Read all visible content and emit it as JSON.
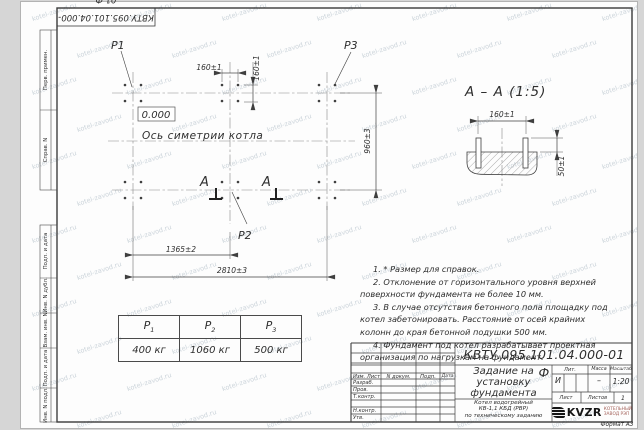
{
  "watermark": "kotel-zavod.ru",
  "corner_stamp": "КВТУ.095.101.04.000-01 Ф",
  "margin_labels": [
    "Перв. примен.",
    "Справ. N",
    "Подп. и дата",
    "Инв. N дубл.",
    "Взам. инв. N",
    "Подп. и дата",
    "Инв. N подл."
  ],
  "plan": {
    "p1": "P1",
    "p2": "P2",
    "p3": "P3",
    "elevation": "0.000",
    "axis_label": "Ось симетрии котла",
    "section_letter": "А",
    "dim_160_h": "160±1",
    "dim_160_v": "160±1",
    "dim_960": "960±3",
    "dim_1365": "1365±2",
    "dim_2810": "2810±3"
  },
  "section_view": {
    "title": "А – А (1:5)",
    "dim_160": "160±1",
    "dim_50": "50±1"
  },
  "load_table": {
    "symbols": [
      "P",
      "P",
      "P"
    ],
    "subs": [
      "1",
      "2",
      "3"
    ],
    "values": [
      "400 кг",
      "1060 кг",
      "500 кг"
    ]
  },
  "notes": [
    "1. * Размер для справок.",
    "2. Отклонение от горизонтального уровня верхней поверхности фундамента не более 10 мм.",
    "3. В случае отсутствия бетонного пола площадку под котел забетонировать. Расстояние от осей крайних колонн до края бетонной подушки 500 мм.",
    "4. Фундамент под котел разрабатывает проектная организация по нагрузкам на фундамент."
  ],
  "title_block": {
    "doc_number": "КВТУ.095.101.04.000-01 Ф",
    "title": "Задание на установку фундамента",
    "subtitle": [
      "Котел водогрейный",
      "КВ-1,1 КБД (РВР)",
      "по техническому заданию"
    ],
    "col_headers": [
      "Изм. Лист",
      "N докум.",
      "Подп.",
      "Дата"
    ],
    "sig_rows": [
      "Разраб.",
      "Пров.",
      "Т.контр.",
      "",
      "Н.контр.",
      "Утв."
    ],
    "lit_label": "Лит.",
    "mass_label": "Масса",
    "scale_label": "Масштаб",
    "lit_value": "И",
    "mass_value": "–",
    "scale_value": "1:20",
    "sheet_label": "Лист",
    "sheets_label": "Листов",
    "sheets_value": "1",
    "logo_text": "KVZR",
    "logo_caption": [
      "КОТЕЛЬНЫЙ",
      "ЗАВОД РЭП"
    ],
    "format_label": "Формат А3"
  },
  "colors": {
    "line": "#3f3f3f",
    "watermark": "#b7c3cc",
    "logo_caption": "#a4625a"
  }
}
